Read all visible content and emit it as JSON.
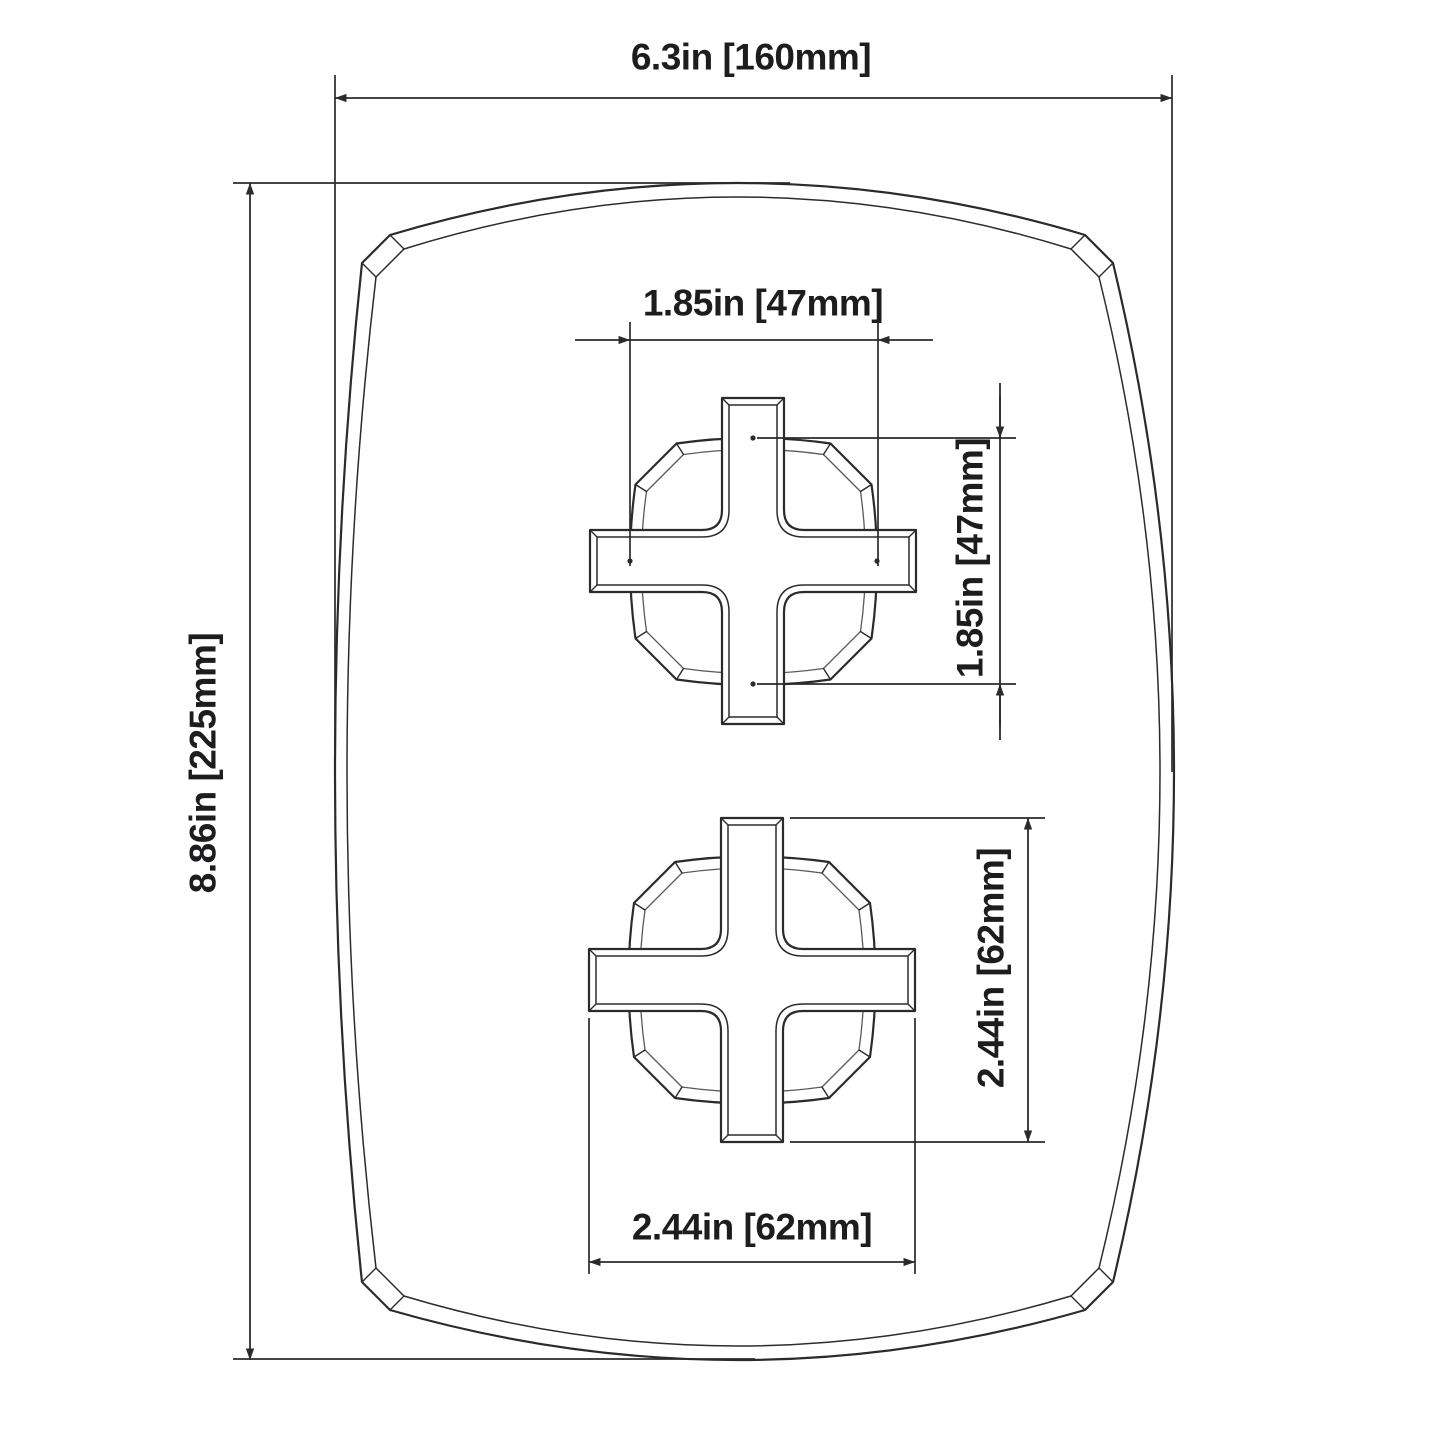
{
  "drawing": {
    "type": "technical-dimension-drawing",
    "subject": "shower-valve-trim-plate-with-two-cross-handles",
    "dimensions": {
      "overall_width": {
        "label": "6.3in [160mm]",
        "inches": 6.3,
        "mm": 160
      },
      "overall_height": {
        "label": "8.86in [225mm]",
        "inches": 8.86,
        "mm": 225
      },
      "upper_handle_width": {
        "label": "1.85in [47mm]",
        "inches": 1.85,
        "mm": 47
      },
      "upper_handle_height": {
        "label": "1.85in [47mm]",
        "inches": 1.85,
        "mm": 47
      },
      "lower_handle_height": {
        "label": "2.44in [62mm]",
        "inches": 2.44,
        "mm": 62
      },
      "lower_handle_width": {
        "label": "2.44in [62mm]",
        "inches": 2.44,
        "mm": 62
      }
    }
  },
  "colors": {
    "line": "#2b2b2b",
    "secondary_line": "#5a5a5a",
    "text": "#1d1d1f",
    "background": "#ffffff"
  }
}
